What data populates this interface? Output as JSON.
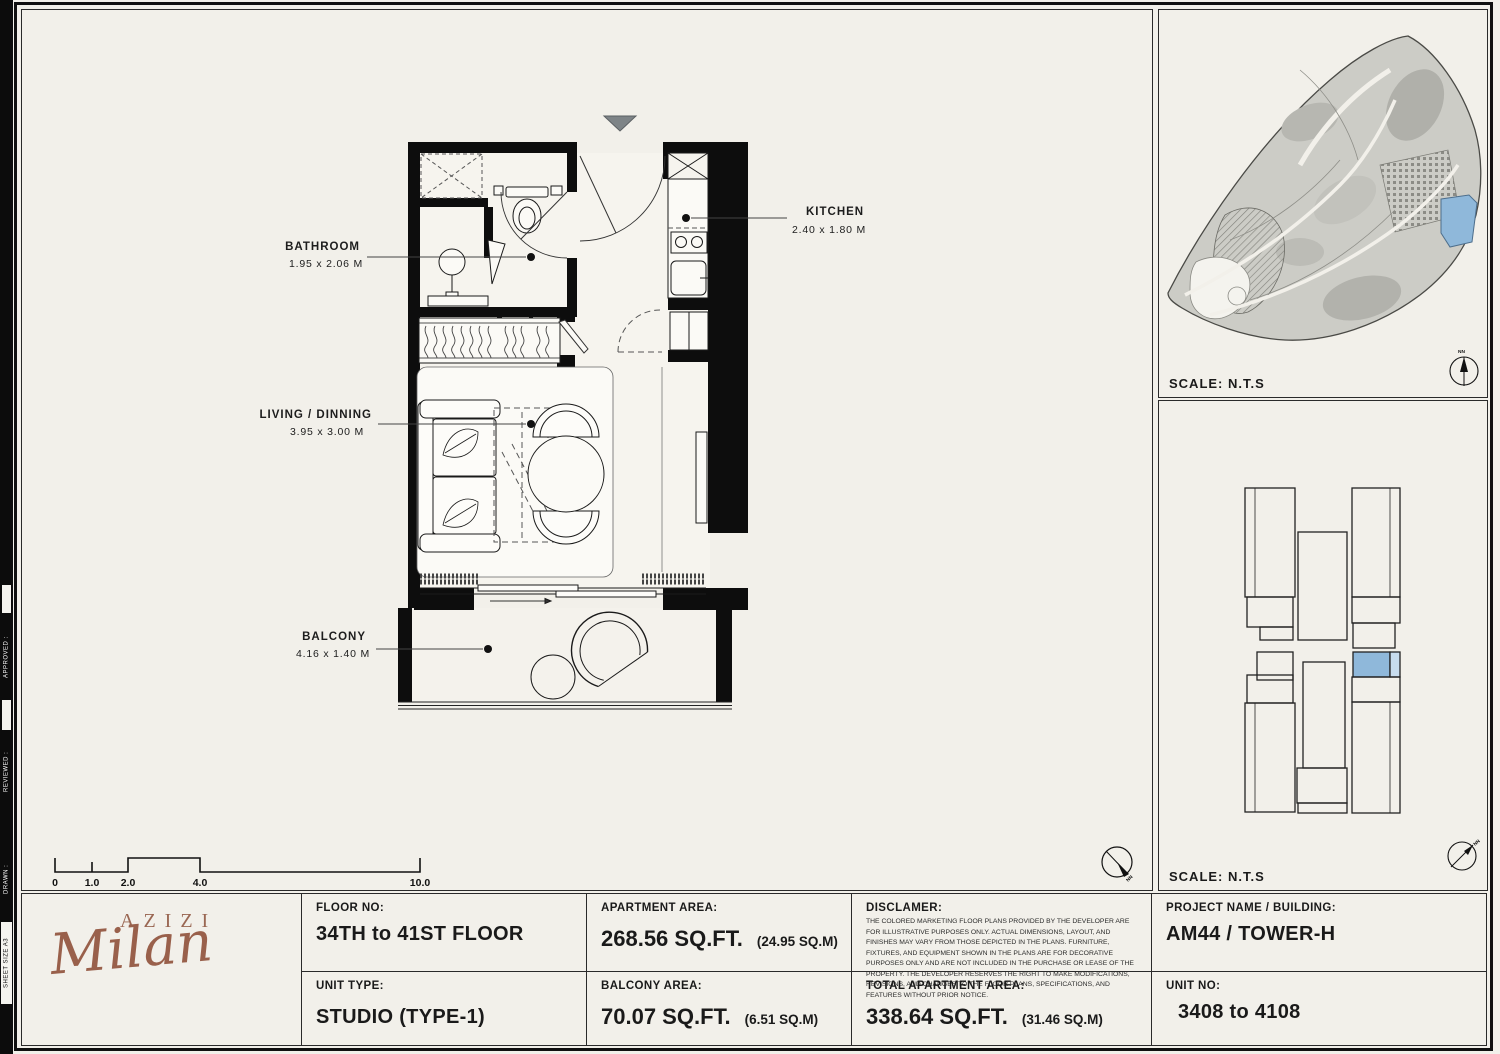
{
  "sidebar": {
    "sheet_size": "SHEET SIZE A3",
    "drawn": "DRAWN :",
    "reviewed": "REVIEWED :",
    "approved": "APPROVED :"
  },
  "plan": {
    "compass_label": "NN",
    "rooms": [
      {
        "name": "BATHROOM",
        "dims": "1.95 x 2.06 M"
      },
      {
        "name": "KITCHEN",
        "dims": "2.40 x 1.80 M"
      },
      {
        "name": "LIVING / DINNING",
        "dims": "3.95 x 3.00 M"
      },
      {
        "name": "BALCONY",
        "dims": "4.16 x 1.40 M"
      }
    ],
    "scale_bar": {
      "labels": [
        "0",
        "1.0",
        "2.0",
        "4.0",
        "10.0"
      ]
    }
  },
  "site_map": {
    "scale_label": "SCALE: N.T.S",
    "compass_label": "NN",
    "highlight_color": "#8fb8da"
  },
  "key_plan": {
    "scale_label": "SCALE: N.T.S",
    "compass_label": "NN",
    "highlight_color": "#8fb8da"
  },
  "title_block": {
    "brand": {
      "name": "AZIZI",
      "logotype": "Milan"
    },
    "floor_no": {
      "label": "FLOOR NO:",
      "value": "34TH to 41ST FLOOR"
    },
    "unit_type": {
      "label": "UNIT TYPE:",
      "value": "STUDIO (TYPE-1)"
    },
    "apartment_area": {
      "label": "APARTMENT AREA:",
      "value": "268.56 SQ.FT.",
      "alt": "(24.95 SQ.M)"
    },
    "balcony_area": {
      "label": "BALCONY AREA:",
      "value": "70.07 SQ.FT.",
      "alt": "(6.51 SQ.M)"
    },
    "disclaimer": {
      "label": "DISCLAMER:",
      "text": "The colored marketing floor plans provided by the developer are for illustrative purposes only. Actual dimensions, layout, and finishes may vary from those depicted in the plans. Furniture, fixtures, and equipment shown in the plans are for decorative purposes only and are not included in the purchase or lease of the property. The developer reserves the right to make modifications, revisions, and changes to the floor plans, specifications, and features without prior notice."
    },
    "total_area": {
      "label": "TOTAL APARTMENT AREA:",
      "value": "338.64 SQ.FT.",
      "alt": "(31.46 SQ.M)"
    },
    "project": {
      "label": "PROJECT NAME / BUILDING:",
      "value": "AM44 / TOWER-H"
    },
    "unit_no": {
      "label": "UNIT NO:",
      "value": "3408 to 4108"
    }
  }
}
